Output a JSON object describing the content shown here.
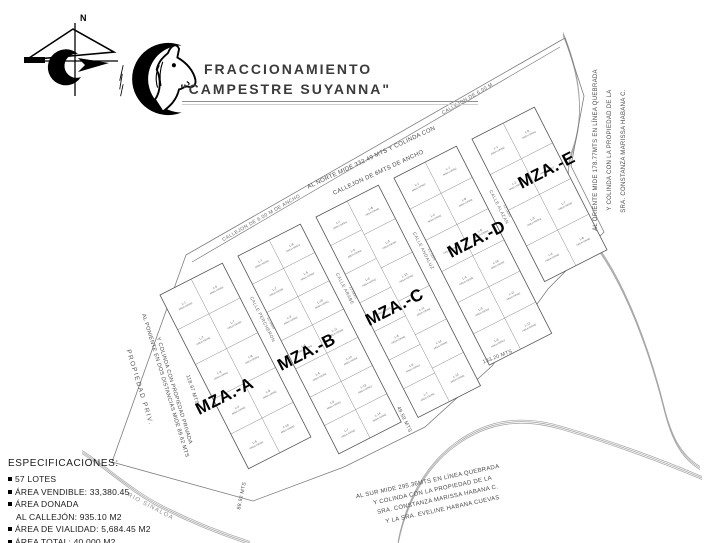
{
  "header": {
    "title_line1": "FRACCIONAMIENTO",
    "title_line2": "\"CAMPESTRE SUYANNA\""
  },
  "compass": {
    "north_label": "N"
  },
  "specifications": {
    "heading": "ESPECIFICACIONES:",
    "items": [
      {
        "bullet": true,
        "text": "57 LOTES"
      },
      {
        "bullet": true,
        "text": "ÁREA VENDIBLE: 33,380.45"
      },
      {
        "bullet": true,
        "text": "ÁREA DONADA"
      },
      {
        "bullet": false,
        "text": "AL CALLEJÓN: 935.10 M2"
      },
      {
        "bullet": true,
        "text": "ÁREA DE VIALIDAD: 5,684.45 M2"
      },
      {
        "bullet": true,
        "text": "ÁREA TOTAL: 40,000 M2"
      }
    ]
  },
  "map": {
    "blocks": [
      {
        "label": "MZA.-A",
        "lot_count": 10
      },
      {
        "label": "MZA.-B",
        "lot_count": 14
      },
      {
        "label": "MZA.-C",
        "lot_count": 13
      },
      {
        "label": "MZA.-D",
        "lot_count": 12
      },
      {
        "label": "MZA.-E",
        "lot_count": 8
      }
    ],
    "lot_prefix": "L-",
    "lot_area_text": "AREA=585M2",
    "streets": [
      {
        "name": "CALLE PERCHERON",
        "width": "12.00m"
      },
      {
        "name": "CALLE ARABE",
        "width": "12.00m"
      },
      {
        "name": "CALLE ANDALUZ",
        "width": "12.00m"
      },
      {
        "name": "CALLE ALAZAN",
        "width": "12.00m"
      }
    ],
    "alley_labels": [
      "CALLEJON DE 6.00 M DE ANCHO",
      "CALLEJON DE 6.00 M"
    ],
    "boundaries": {
      "north": [
        "AL NORTE MIDE 332.49 MTS Y COLINDA CON",
        "CALLEJON DE 6MTS DE ANCHO"
      ],
      "east": [
        "AL ORIENTE MIDE 178.77MTS EN LÍNEA QUEBRADA",
        "Y COLINDA CON LA PROPIEDAD DE LA",
        "SRA. CONSTANZA MARISSA HABANA C."
      ],
      "south": [
        "AL SUR MIDE 295.36MTS EN LÍNEA QUEBRADA",
        "Y COLINDA CON LA PROPIEDAD DE LA",
        "SRA. CONSTANZA MARISSA HABANA C.",
        "Y LA SRA. EVELINE HABANA CUEVAS"
      ],
      "west": [
        "AL PONIENTE EN DOS DISTANCIAS MIDE 89.62 MTS",
        "Y COLINDA CON PROPIEDAD PRIVADA"
      ],
      "west_property": "PROPIEDAD PRIV."
    },
    "dimensions": [
      "118.97 MTS",
      "133.20 MTS",
      "49.59 MTS",
      "88.92 MTS"
    ],
    "river_label": "RIO SINALOA"
  }
}
